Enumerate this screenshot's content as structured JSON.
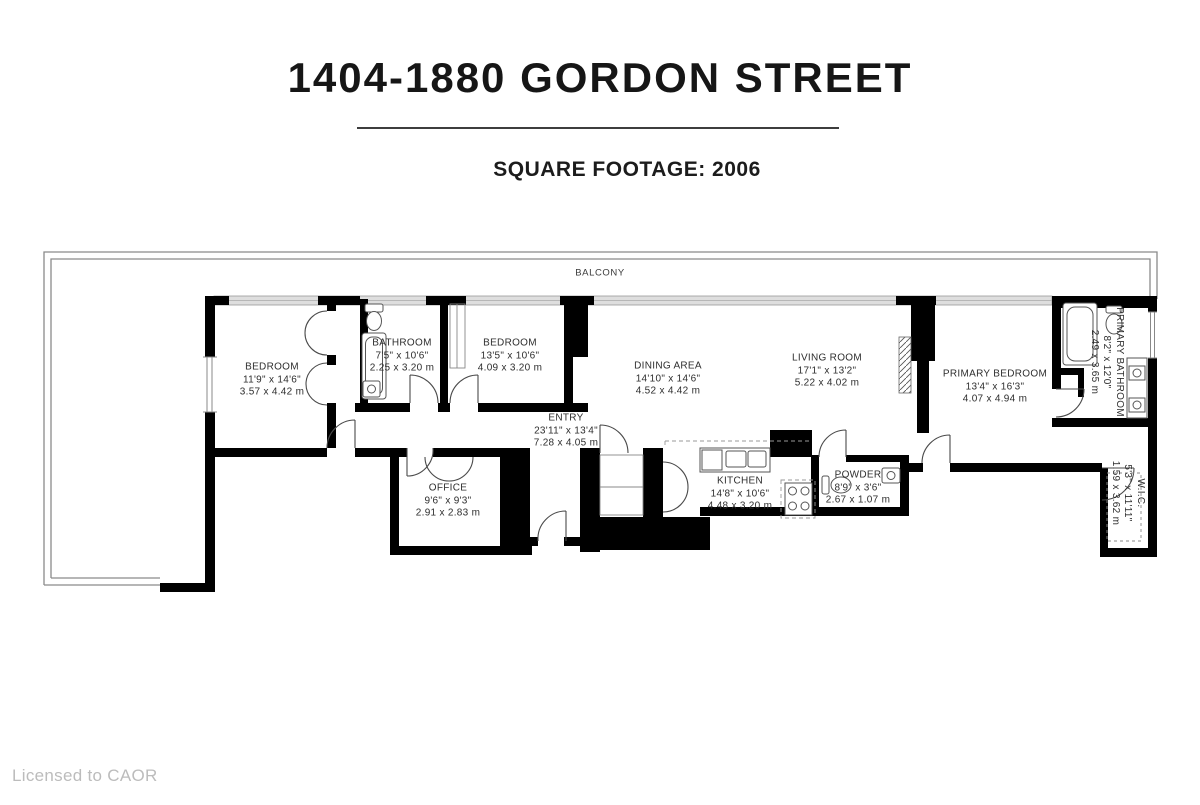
{
  "header": {
    "title": "1404-1880 GORDON STREET",
    "subtitle": "SQUARE FOOTAGE: 2006"
  },
  "footer": {
    "license": "Licensed to CAOR"
  },
  "floorplan": {
    "balcony_label": "BALCONY",
    "rooms": [
      {
        "name": "BEDROOM",
        "imperial": "11'9\" x 14'6\"",
        "metric": "3.57 x 4.42 m"
      },
      {
        "name": "BATHROOM",
        "imperial": "7'5\" x 10'6\"",
        "metric": "2.25 x 3.20 m"
      },
      {
        "name": "BEDROOM",
        "imperial": "13'5\" x 10'6\"",
        "metric": "4.09 x 3.20 m"
      },
      {
        "name": "ENTRY",
        "imperial": "23'11\" x 13'4\"",
        "metric": "7.28 x 4.05 m"
      },
      {
        "name": "DINING AREA",
        "imperial": "14'10\" x 14'6\"",
        "metric": "4.52 x 4.42 m"
      },
      {
        "name": "LIVING ROOM",
        "imperial": "17'1\" x 13'2\"",
        "metric": "5.22 x 4.02 m"
      },
      {
        "name": "PRIMARY BEDROOM",
        "imperial": "13'4\" x 16'3\"",
        "metric": "4.07 x 4.94 m"
      },
      {
        "name": "PRIMARY BATHROOM",
        "imperial": "8'2\" x 12'0\"",
        "metric": "2.49 x 3.65 m"
      },
      {
        "name": "W.I.C.",
        "imperial": "5'3\" x 11'11\"",
        "metric": "1.59 x 3.62 m"
      },
      {
        "name": "OFFICE",
        "imperial": "9'6\" x 9'3\"",
        "metric": "2.91 x 2.83 m"
      },
      {
        "name": "KITCHEN",
        "imperial": "14'8\" x 10'6\"",
        "metric": "4.48 x 3.20 m"
      },
      {
        "name": "POWDER",
        "imperial": "8'9\" x 3'6\"",
        "metric": "2.67 x 1.07 m"
      }
    ],
    "colors": {
      "wall": "#000000",
      "line": "#555555",
      "window_band": "#dedede",
      "label_text": "#2e2e2e"
    }
  }
}
